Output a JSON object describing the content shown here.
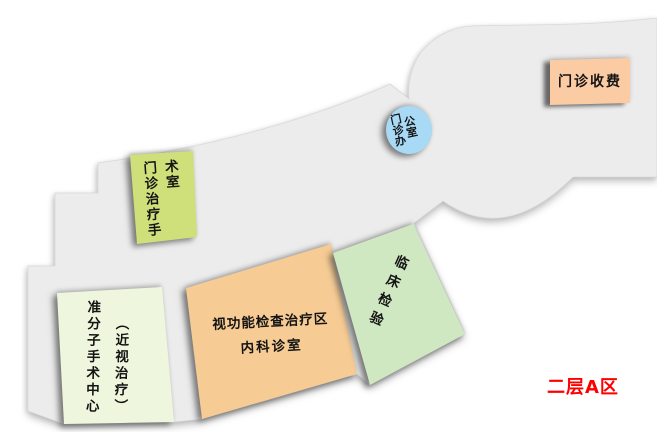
{
  "area_label": "二层A区",
  "rooms": {
    "cashier": {
      "label": "门诊收费"
    },
    "office": {
      "label": "门诊办公室",
      "col1": "门诊办",
      "col2": "公室"
    },
    "surgery": {
      "label": "门诊治疗手术室",
      "col1": "门诊治疗手",
      "col2": "术室"
    },
    "vision": {
      "line1": "视功能检查治疗区",
      "line2": "内科诊室"
    },
    "lab": {
      "label": "临床检验"
    },
    "excimer": {
      "label": "准分子手术中心（近视治疗）",
      "col1": "准分子手术中心",
      "col2": "（近视治疗）"
    }
  },
  "colors": {
    "floor": "#ececec",
    "surgery_room": "#cfe07a",
    "office_room": "#a8d9f5",
    "cashier_room": "#fbcba3",
    "vision_room": "#f6cb94",
    "lab_room": "#cfe8c2",
    "excimer_room": "#eef6dd",
    "area_label_color": "#ff0000"
  }
}
